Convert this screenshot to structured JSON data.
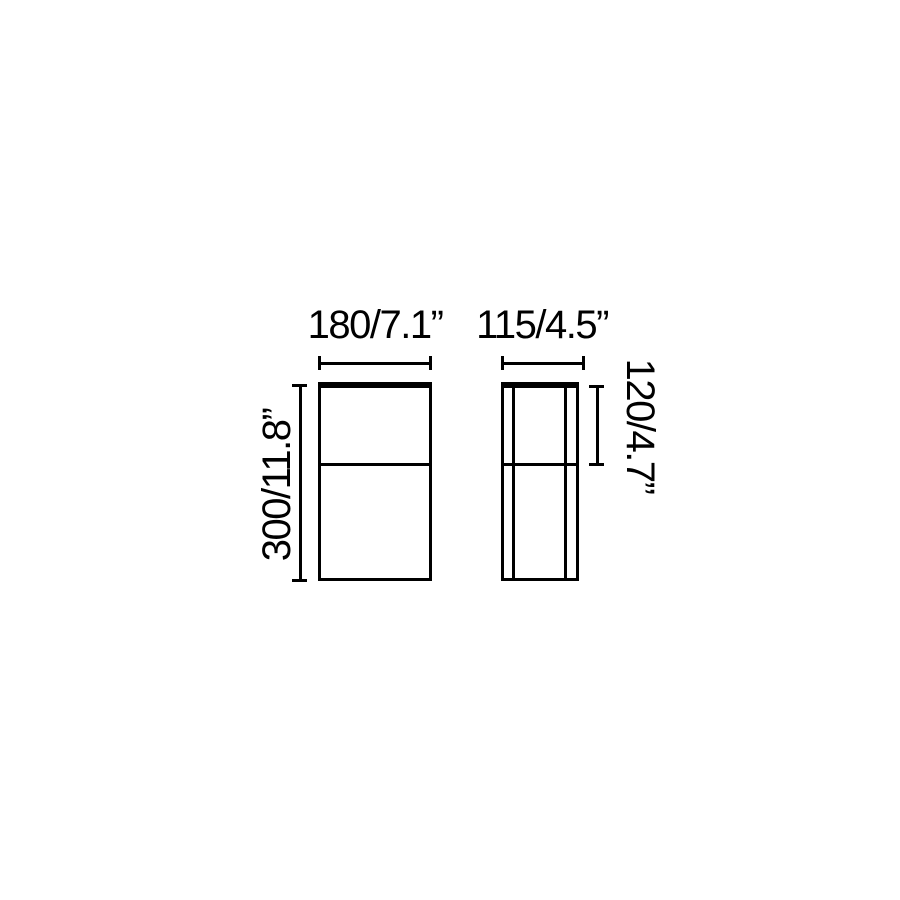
{
  "colors": {
    "background": "#ffffff",
    "ink": "#000000"
  },
  "drawing": {
    "type": "technical-dimension-diagram",
    "front_view": {
      "width_label": "180/7.1”",
      "height_label": "300/11.8”",
      "width_mm": 180,
      "width_in": 7.1,
      "height_mm": 300,
      "height_in": 11.8
    },
    "side_view": {
      "width_label": "115/4.5”",
      "upper_section_label": "120/4.7”",
      "width_mm": 115,
      "width_in": 4.5,
      "upper_section_mm": 120,
      "upper_section_in": 4.7
    }
  }
}
